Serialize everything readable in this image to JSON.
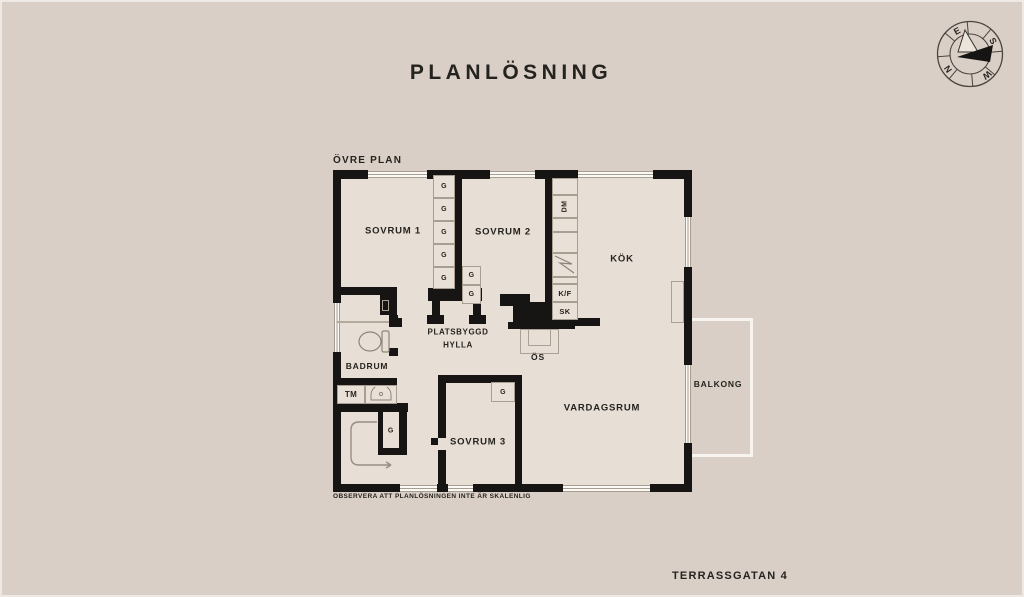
{
  "page": {
    "title": "PLANLÖSNING",
    "plan_level_label": "ÖVRE PLAN",
    "scale_note": "OBSERVERA ATT PLANLÖSNINGEN INTE ÄR SKALENLIG",
    "address": "TERRASSGATAN 4"
  },
  "compass": {
    "n": "N",
    "e": "E",
    "s": "S",
    "w": "W"
  },
  "rooms": {
    "sovrum1": "SOVRUM 1",
    "sovrum2": "SOVRUM 2",
    "sovrum3": "SOVRUM 3",
    "kok": "KÖK",
    "badrum": "BADRUM",
    "vardagsrum": "VARDAGSRUM",
    "balkong": "BALKONG"
  },
  "fixtures": {
    "wardrobe": "G",
    "dishwasher": "DM",
    "fridge_freezer": "K/F",
    "cabinet": "SK",
    "washing_machine": "TM",
    "fireplace": "ÖS",
    "shelf_line1": "PLATSBYGGD",
    "shelf_line2": "HYLLA"
  },
  "colors": {
    "background": "#d9cfc6",
    "floor": "#e7ded5",
    "wall": "#161513",
    "window": "#fbf9f5",
    "text": "#25231f"
  }
}
